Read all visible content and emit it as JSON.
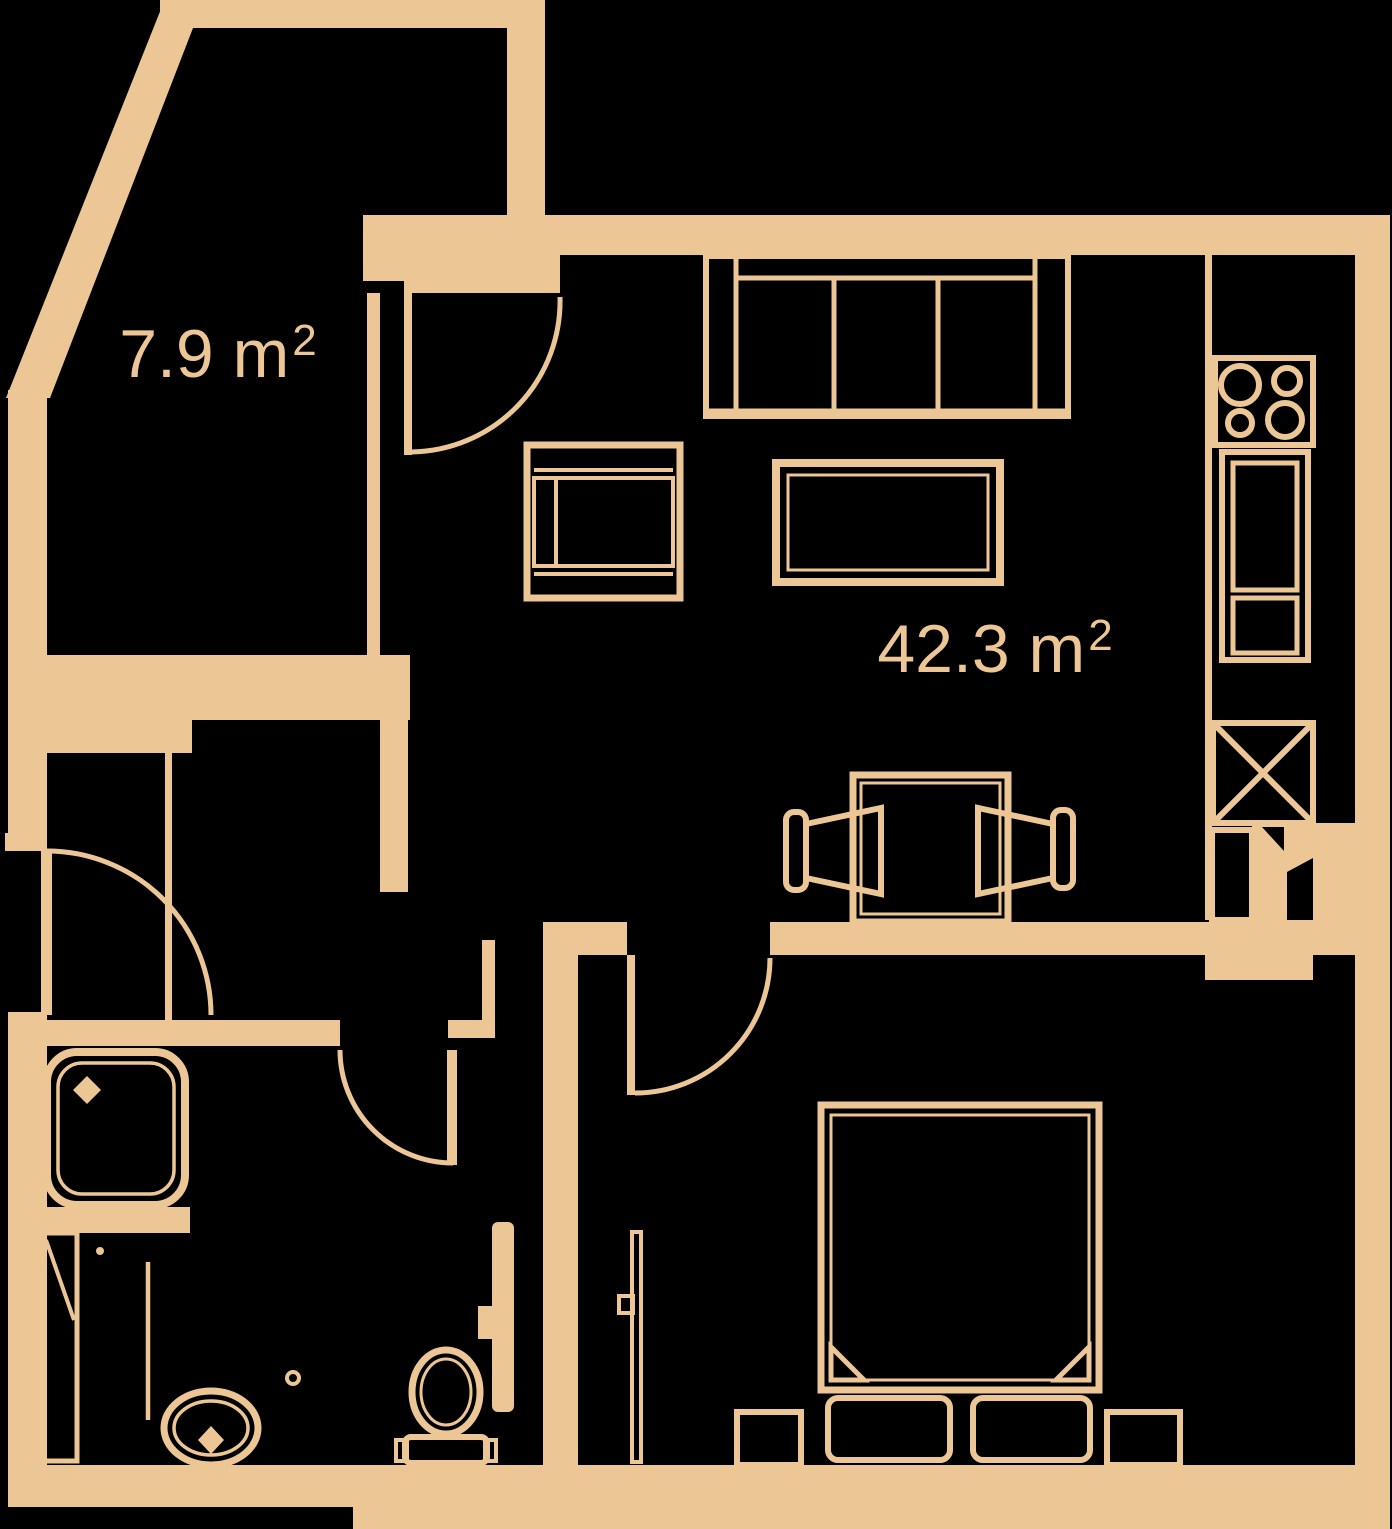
{
  "document": {
    "type": "apartment-floor-plan",
    "background_color": "#000000",
    "wall_color": "#ecc795"
  },
  "labels": {
    "small_room": {
      "text": "7.9 m²",
      "prefix": "7.9 m",
      "sup": "2"
    },
    "living_room": {
      "text": "42.3 m²",
      "prefix": "42.3 m",
      "sup": "2"
    }
  },
  "fixtures": [
    "sofa",
    "coffee-table",
    "tv-cabinet",
    "cooktop",
    "oven",
    "fridge",
    "kitchen-counter",
    "desk",
    "chair",
    "bed",
    "pillow",
    "nightstand",
    "shower",
    "washing-machine",
    "washbasin",
    "toilet",
    "door"
  ]
}
